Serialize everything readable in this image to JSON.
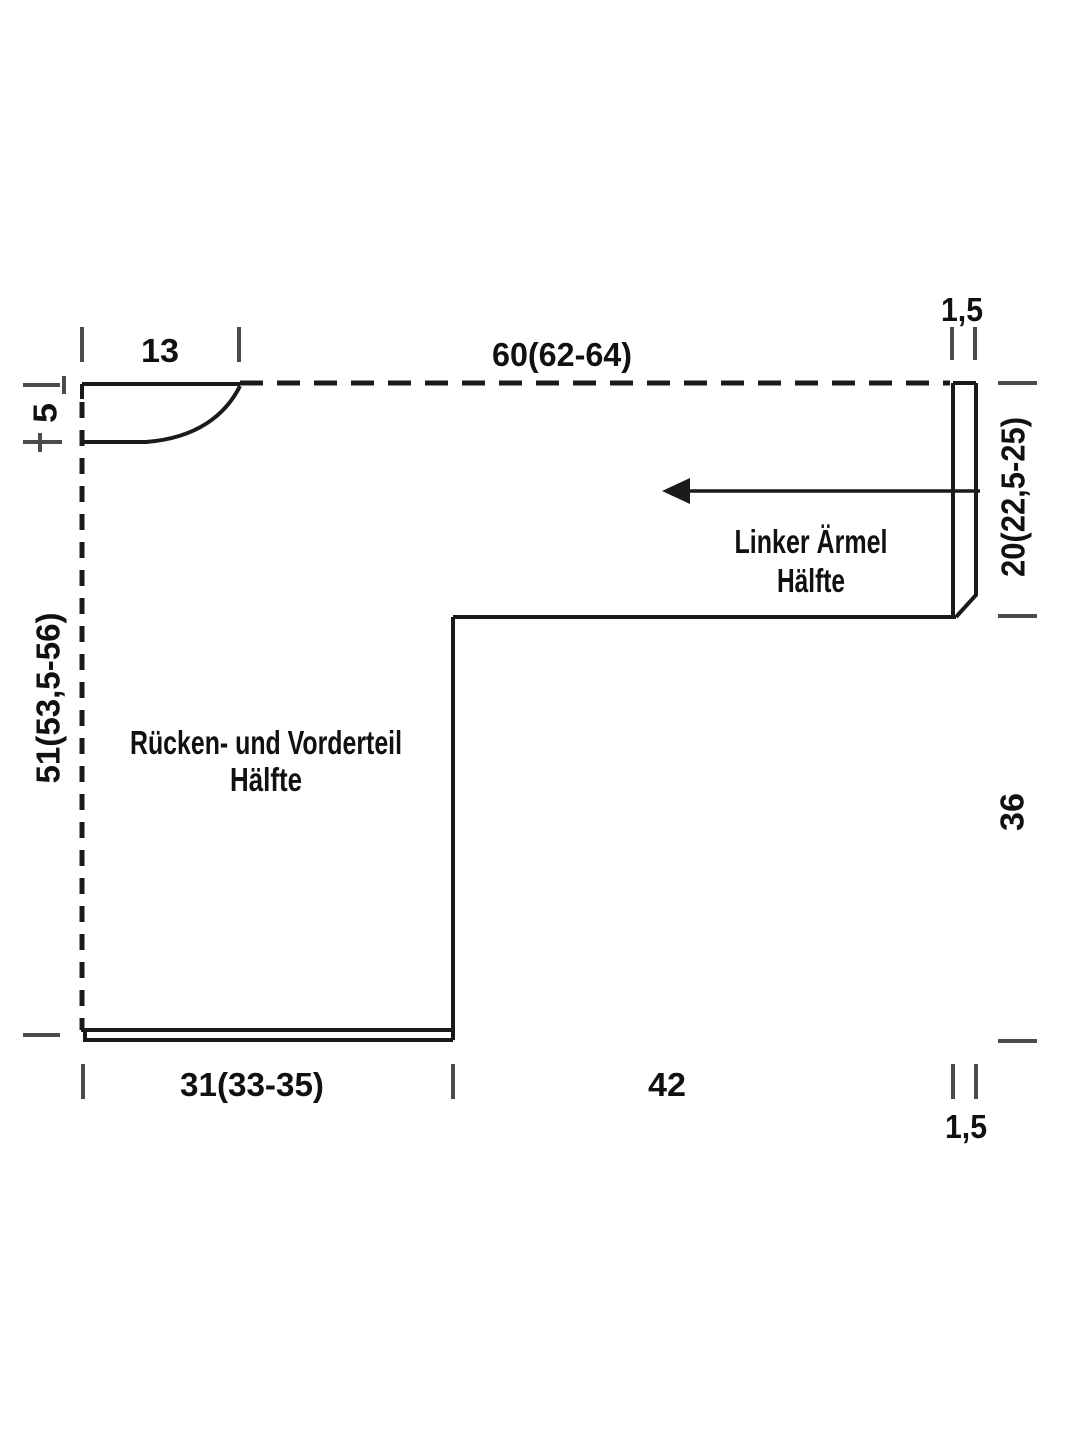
{
  "diagram": {
    "type": "knitting-pattern-schematic",
    "background_color": "#ffffff",
    "line_color": "#1a1a1a",
    "tick_color": "#4b4b4b",
    "text_color": "#111111",
    "pieces": {
      "body": {
        "label_line1": "Rücken- und Vorderteil",
        "label_line2": "Hälfte"
      },
      "sleeve": {
        "label_line1": "Linker Ärmel",
        "label_line2": "Hälfte"
      }
    },
    "measurements": {
      "neck_width": "13",
      "top_width": "60(62-64)",
      "cuff_width_top": "1,5",
      "neck_depth": "5",
      "back_length": "51(53,5-56)",
      "sleeve_width": "20(22,5-25)",
      "side_seam": "36",
      "hem_half_width": "31(33-35)",
      "sleeve_length": "42",
      "cuff_width_bottom": "1,5"
    }
  }
}
